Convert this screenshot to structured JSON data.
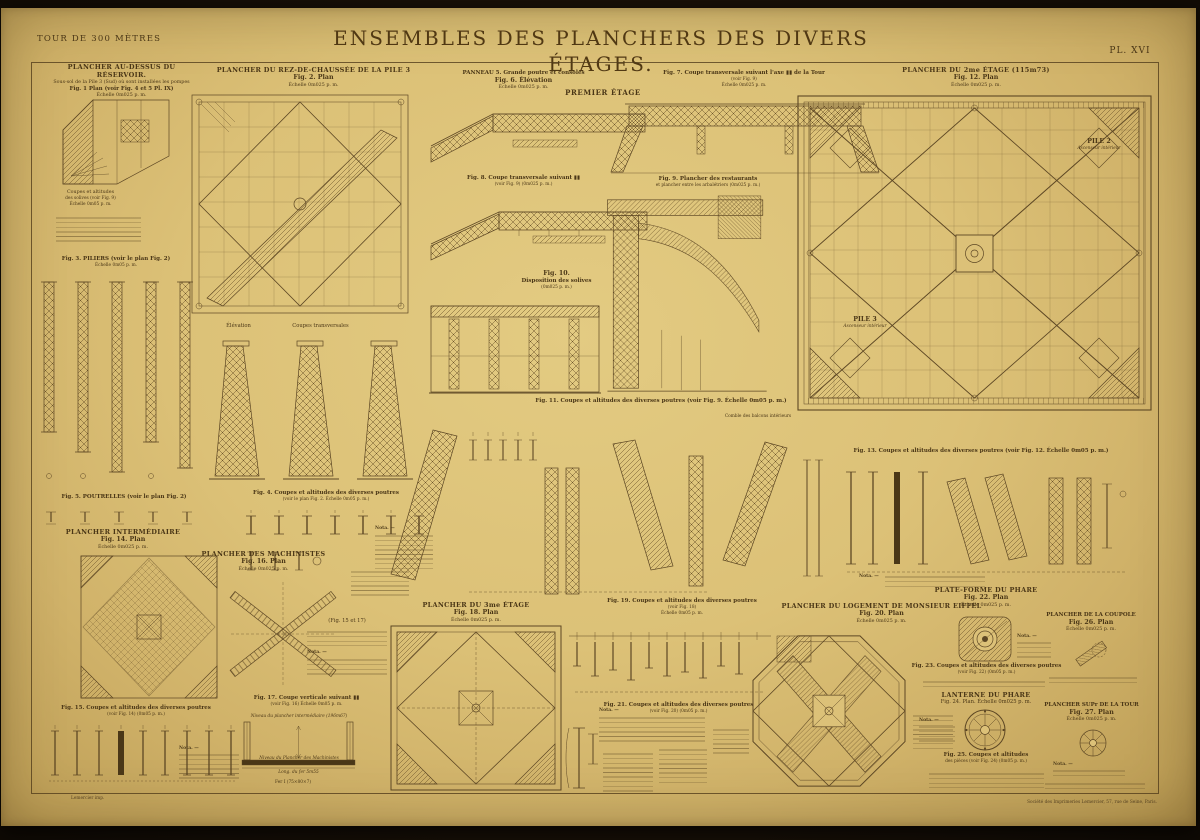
{
  "page": {
    "series": "TOUR DE 300 MÈTRES",
    "title": "ENSEMBLES DES PLANCHERS DES DIVERS ÉTAGES.",
    "plate_no": "PL. XVI",
    "printer_left": "Lemercier imp.",
    "printer_right": "Société des Imprimeries Lemercier, 57, rue de Seine, Paris."
  },
  "labels": {
    "premier_etage": "PREMIER ÉTAGE",
    "elevation": "Élévation",
    "coupes_transversales": "Coupes transversales",
    "comble": "Comble des balcons intérieurs",
    "pile2": "PILE 2",
    "pile3": "PILE 3",
    "ascenseur": "Ascenseur intérieur",
    "fig_15_17": "(Fig. 15 et 17)",
    "nota": "Nota. —",
    "solives_1": "Coupes et altitudes",
    "solives_2": "des solives (voir Fig. 9)",
    "solives_3": "Échelle 0m05 p. m.",
    "niveau_intermediaire": "Niveau du plancher intermédiaire (196m67)",
    "niveau_machinistes": "Niveau du Plancher des Machinistes",
    "long_fer": "Long. du fer 5m55",
    "fer_i": "Fer I (75×80×7)"
  },
  "figures": {
    "f1": {
      "heading": "PLANCHER AU-DESSUS DU RÉSERVOIR.",
      "sub": "Sous-sol de la Pile 3 (Sud) où sont installées les pompes",
      "caption": "Fig. 1 Plan (voir Fig. 4 et 5 Pl. IX)",
      "scale": "Échelle 0m025 p. m."
    },
    "f2": {
      "heading": "PLANCHER DU REZ-DE-CHAUSSÉE DE LA PILE 3",
      "caption": "Fig. 2. Plan",
      "scale": "Échelle 0m025 p. m."
    },
    "f3": {
      "caption": "Fig. 3. PILIERS (voir le plan Fig. 2)",
      "scale": "Échelle 0m05 p. m."
    },
    "f4": {
      "caption": "Fig. 4. Coupes et altitudes des diverses poutres",
      "scale": "(voir le plan Fig. 2. Échelle 0m05 p. m.)"
    },
    "f5": {
      "caption": "Fig. 5. POUTRELLES (voir le plan Fig. 2)"
    },
    "f6": {
      "heading": "PANNEAU 5. Grande poutre et consoles",
      "caption": "Fig. 6. Élévation",
      "scale": "Échelle 0m025 p. m."
    },
    "f7": {
      "caption": "Fig. 7. Coupe transversale suivant l'axe ▮▮ de la Tour",
      "sub": "(voir Fig. 9)",
      "scale": "Échelle 0m025 p. m."
    },
    "f8": {
      "caption": "Fig. 8. Coupe transversale suivant ▮▮",
      "scale": "(voir Fig. 9) (0m025 p. m.)"
    },
    "f9": {
      "caption": "Fig. 9. Plancher des restaurants",
      "sub": "et plancher entre les arbalétriers (0m025 p. m.)"
    },
    "f10": {
      "caption": "Fig. 10.",
      "sub": "Disposition des solives",
      "scale": "(0m025 p. m.)"
    },
    "f11": {
      "caption": "Fig. 11. Coupes et altitudes des diverses poutres (voir Fig. 9. Échelle 0m05 p. m.)"
    },
    "f12": {
      "heading": "PLANCHER DU 2me ÉTAGE (115m73)",
      "caption": "Fig. 12. Plan",
      "scale": "Échelle 0m025 p. m."
    },
    "f13": {
      "caption": "Fig. 13. Coupes et altitudes des diverses poutres (voir Fig. 12. Échelle 0m05 p. m.)"
    },
    "f14": {
      "heading": "PLANCHER INTERMÉDIAIRE",
      "caption": "Fig. 14. Plan",
      "scale": "Échelle 0m025 p. m."
    },
    "f15": {
      "caption": "Fig. 15. Coupes et altitudes des diverses poutres",
      "scale": "(voir Fig. 14) (0m05 p. m.)"
    },
    "f16": {
      "heading": "PLANCHER DES MACHINISTES",
      "caption": "Fig. 16. Plan",
      "scale": "Échelle 0m025 p. m."
    },
    "f17": {
      "caption": "Fig. 17. Coupe verticale suivant ▮▮",
      "scale": "(voir Fig. 16) Échelle 0m05 p. m."
    },
    "f18": {
      "heading": "PLANCHER DU 3me ÉTAGE",
      "caption": "Fig. 18. Plan",
      "scale": "Échelle 0m025 p. m."
    },
    "f19": {
      "caption": "Fig. 19. Coupes et altitudes des diverses poutres",
      "sub": "(voir Fig. 18)",
      "scale": "Échelle 0m05 p. m."
    },
    "f20": {
      "heading": "PLANCHER DU LOGEMENT DE MONSIEUR EIFFEL",
      "caption": "Fig. 20. Plan",
      "scale": "Échelle 0m025 p. m."
    },
    "f21": {
      "caption": "Fig. 21. Coupes et altitudes des diverses poutres",
      "scale": "(voir Fig. 20) (0m05 p. m.)"
    },
    "f22": {
      "heading": "PLATE-FORME DU PHARE",
      "caption": "Fig. 22. Plan",
      "scale": "Échelle 0m025 p. m."
    },
    "f23": {
      "caption": "Fig. 23. Coupes et altitudes des diverses poutres",
      "scale": "(voir Fig. 22) (0m05 p. m.)"
    },
    "f24": {
      "heading": "LANTERNE DU PHARE",
      "caption": "Fig. 24. Plan. Échelle 0m025 p. m."
    },
    "f25": {
      "caption": "Fig. 25. Coupes et altitudes",
      "scale": "des pièces (voir Fig. 24) (0m05 p. m.)"
    },
    "f26": {
      "heading": "PLANCHER DE LA COUPOLE",
      "caption": "Fig. 26. Plan",
      "scale": "Échelle 0m025 p. m."
    },
    "f27": {
      "heading": "PLANCHER SUPr DE LA TOUR",
      "caption": "Fig. 27. Plan",
      "scale": "Échelle 0m025 p. m."
    }
  }
}
